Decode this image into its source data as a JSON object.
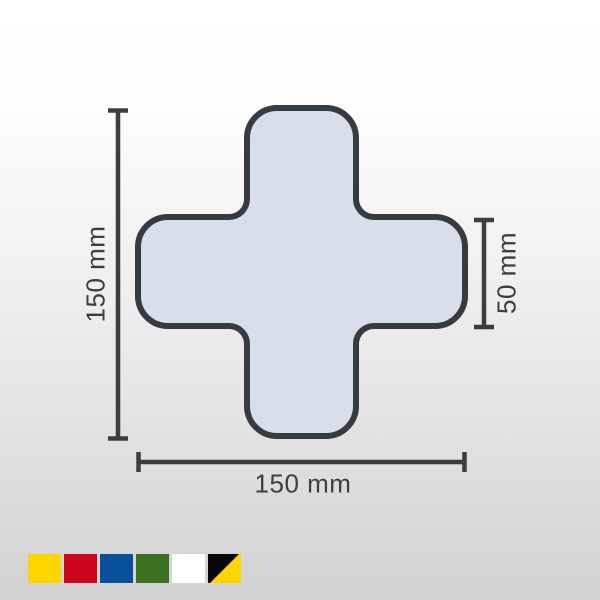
{
  "diagram": {
    "shape_name": "cross",
    "fill_color": "#d8deea",
    "outline_color": "#363a41",
    "dimension_line_color": "#3d3d3d",
    "dimensions": {
      "height": {
        "label": "150 mm",
        "position": "left",
        "orientation": "vertical"
      },
      "width": {
        "label": "150 mm",
        "position": "bottom",
        "orientation": "horizontal"
      },
      "arm_width": {
        "label": "50 mm",
        "position": "right",
        "orientation": "vertical"
      }
    }
  },
  "swatches": [
    {
      "name": "yellow",
      "color": "#fed500"
    },
    {
      "name": "red",
      "color": "#cd051d"
    },
    {
      "name": "blue",
      "color": "#09509a"
    },
    {
      "name": "green",
      "color": "#3b7120"
    },
    {
      "name": "white",
      "color": "#ffffff"
    },
    {
      "name": "black-yellow",
      "color": [
        "#060606",
        "#fed500"
      ]
    }
  ]
}
